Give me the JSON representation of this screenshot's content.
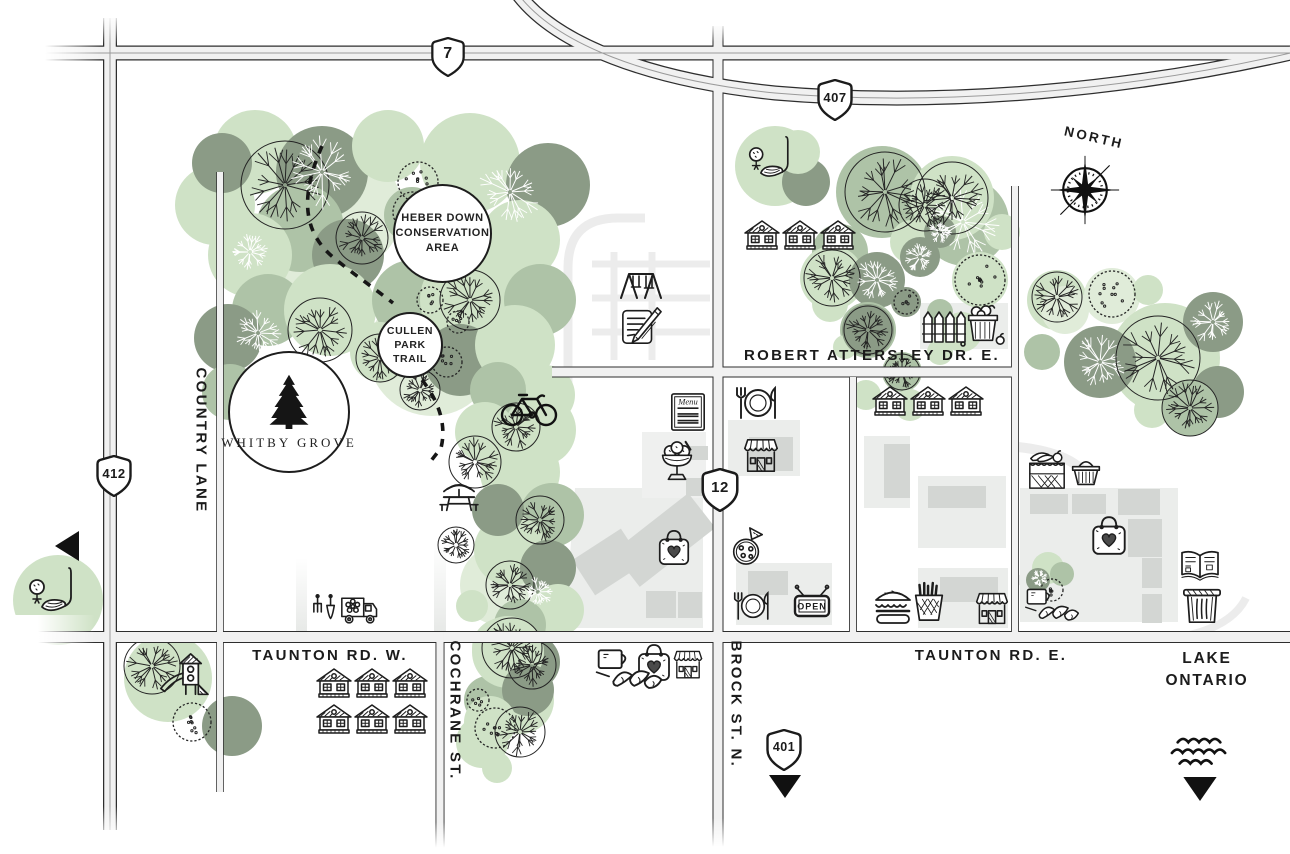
{
  "title": "Whitby Grove community area map",
  "brand": {
    "name": "WHITBY GROVE"
  },
  "badges": {
    "heber1": "HEBER DOWN",
    "heber2": "CONSERVATION",
    "heber3": "AREA",
    "cullen1": "CULLEN",
    "cullen2": "PARK",
    "cullen3": "TRAIL"
  },
  "highways": {
    "h7": "7",
    "h407": "407",
    "h412": "412",
    "h12": "12",
    "h401": "401"
  },
  "streets": {
    "country_lane": "COUNTRY LANE",
    "cochrane": "COCHRANE ST.",
    "brock": "BROCK ST. N.",
    "taunton_w": "TAUNTON RD. W.",
    "taunton_e": "TAUNTON RD. E.",
    "robert_attersley": "ROBERT ATTERSLEY DR. E."
  },
  "landmarks": {
    "north": "NORTH",
    "lake1": "LAKE",
    "lake2": "ONTARIO"
  },
  "signs": {
    "menu": "Menu",
    "open": "OPEN"
  },
  "amenities": [
    "golf-course",
    "playground",
    "swing-set",
    "school-notepad",
    "menu-board",
    "restaurant-plate",
    "ice-cream-sundae",
    "storefront",
    "pizza",
    "open-sign",
    "gift-bag-heart",
    "cafe-croissant",
    "burger",
    "fries",
    "garden-fence",
    "harvest-basket",
    "garden-tools",
    "flower-delivery-truck",
    "picnic-table",
    "bicycle-trail",
    "fruit-market",
    "shopping-basket",
    "library-book",
    "waste-bin",
    "compass-rose",
    "lake-waves",
    "pine-tree-logo",
    "houses"
  ],
  "colors": {
    "tree_light": "#cfe2c6",
    "tree_mid": "#aec3a7",
    "tree_dark": "#8b9b86",
    "tree_pale": "#e0ecd9",
    "road_fill": "#f1f1f1",
    "road_edge": "#2e2e2e",
    "building": "#d3d6d3",
    "block": "#ebedeb",
    "ink": "#1d1d1d"
  }
}
